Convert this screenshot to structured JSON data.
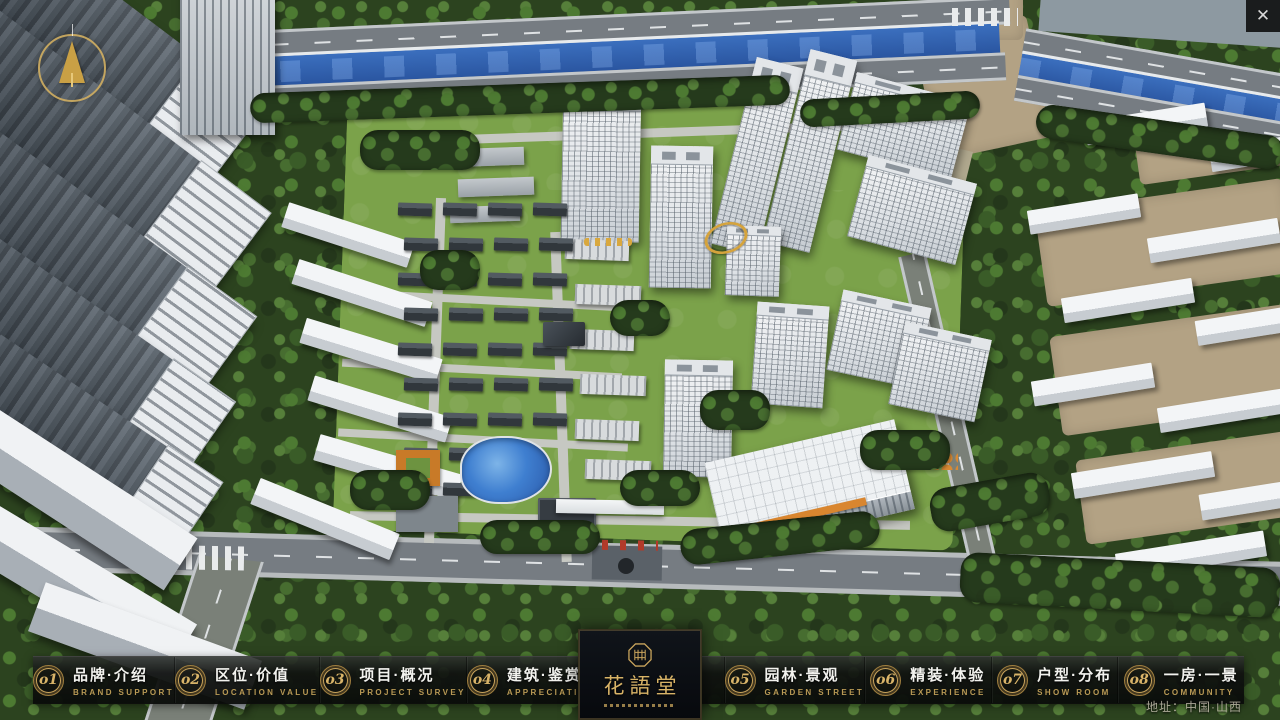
{
  "window": {
    "close_glyph": "✕"
  },
  "colors": {
    "gold": "#c9a45c",
    "gold-dim": "#9a7c3e",
    "bar-bg": "#101210",
    "river-blue": "#2f63b4",
    "tree-green": "#2c431f",
    "logo-bg": "#0b0e12"
  },
  "navbar": {
    "items": [
      {
        "id": "brand-intro",
        "num": "o1",
        "label": "品牌·介绍",
        "sub": "BRAND SUPPORT"
      },
      {
        "id": "location-value",
        "num": "o2",
        "label": "区位·价值",
        "sub": "LOCATION VALUE"
      },
      {
        "id": "project-overview",
        "num": "o3",
        "label": "项目·概况",
        "sub": "PROJECT SURVEY"
      },
      {
        "id": "architecture",
        "num": "o4",
        "label": "建筑·鉴赏",
        "sub": "APPRECIATION"
      },
      {
        "id": "garden-landscape",
        "num": "o5",
        "label": "园林·景观",
        "sub": "GARDEN STREET"
      },
      {
        "id": "interior-experience",
        "num": "o6",
        "label": "精装·体验",
        "sub": "EXPERIENCE"
      },
      {
        "id": "floorplan-distribution",
        "num": "o7",
        "label": "户型·分布",
        "sub": "SHOW ROOM"
      },
      {
        "id": "room-view",
        "num": "o8",
        "label": "一房·一景",
        "sub": "COMMUNITY"
      }
    ]
  },
  "logo": {
    "name": "花語堂"
  },
  "footer": {
    "address": "地址：中国·山西"
  }
}
